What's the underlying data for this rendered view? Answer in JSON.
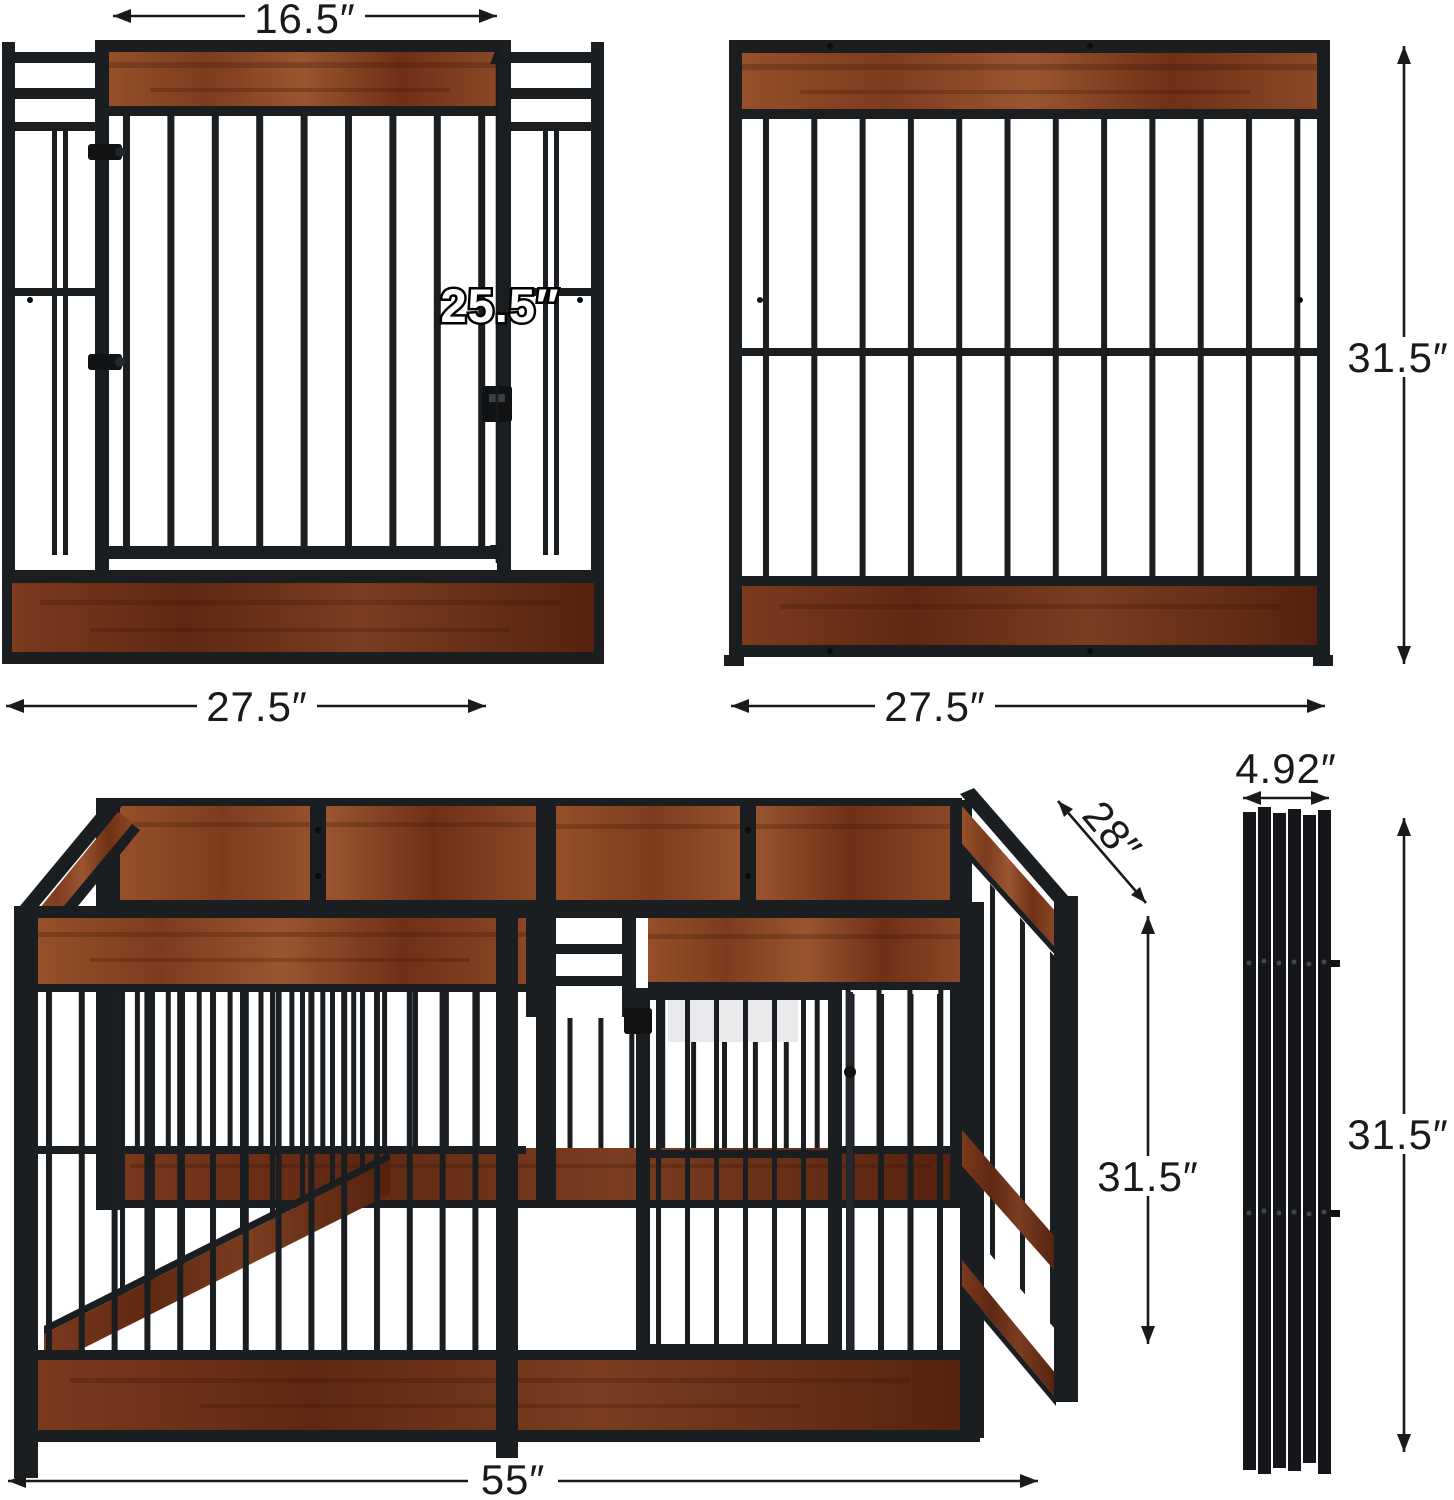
{
  "colors": {
    "background": "#ffffff",
    "metal_frame": "#1b1e21",
    "wood": "#8a4826",
    "wood_dark": "#6b2e16",
    "dimension": "#1a1a1a"
  },
  "views": {
    "door_panel": {
      "dimensions": {
        "door_width": "16.5″",
        "door_height": "25.5″",
        "panel_width": "27.5″"
      }
    },
    "plain_panel": {
      "dimensions": {
        "panel_width": "27.5″",
        "panel_height": "31.5″"
      }
    },
    "assembled_pen": {
      "dimensions": {
        "depth": "28″",
        "height": "31.5″",
        "width": "55″"
      }
    },
    "folded_panels": {
      "dimensions": {
        "thickness": "4.92″",
        "height": "31.5″"
      }
    }
  }
}
